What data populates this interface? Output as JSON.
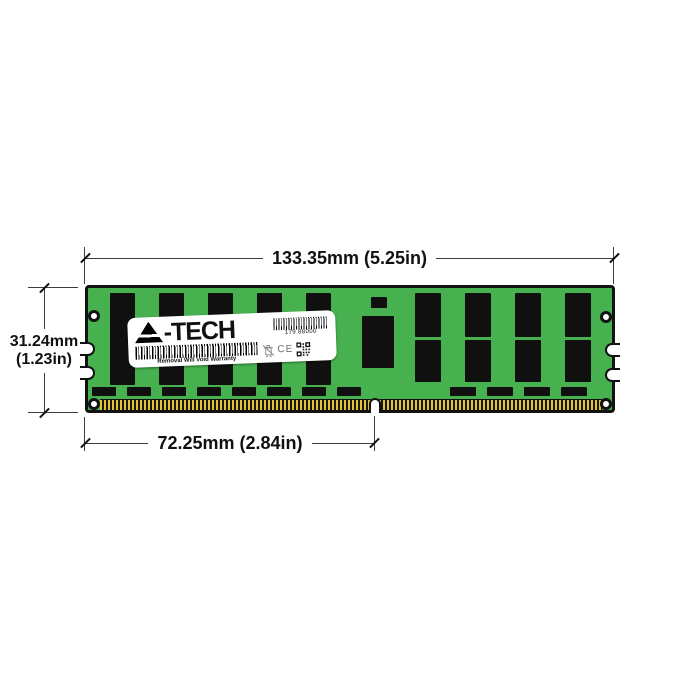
{
  "theme": {
    "pcb-green": "#46b14e",
    "chip-black": "#101010",
    "pin-gold": "#e2c135",
    "line-color": "#3d3d3d",
    "text-color": "#111111"
  },
  "module_label": {
    "brand_initial": "A",
    "brand_rest": "-TECH",
    "serial_number": "179 88000",
    "warranty_text": "Removal Will Void Warranty",
    "ce_mark": "CE"
  },
  "dimensions": {
    "width": "133.35mm (5.25in)",
    "height_line1": "31.24mm",
    "height_line2": "(1.23in)",
    "pin_width": "72.25mm (2.84in)"
  }
}
